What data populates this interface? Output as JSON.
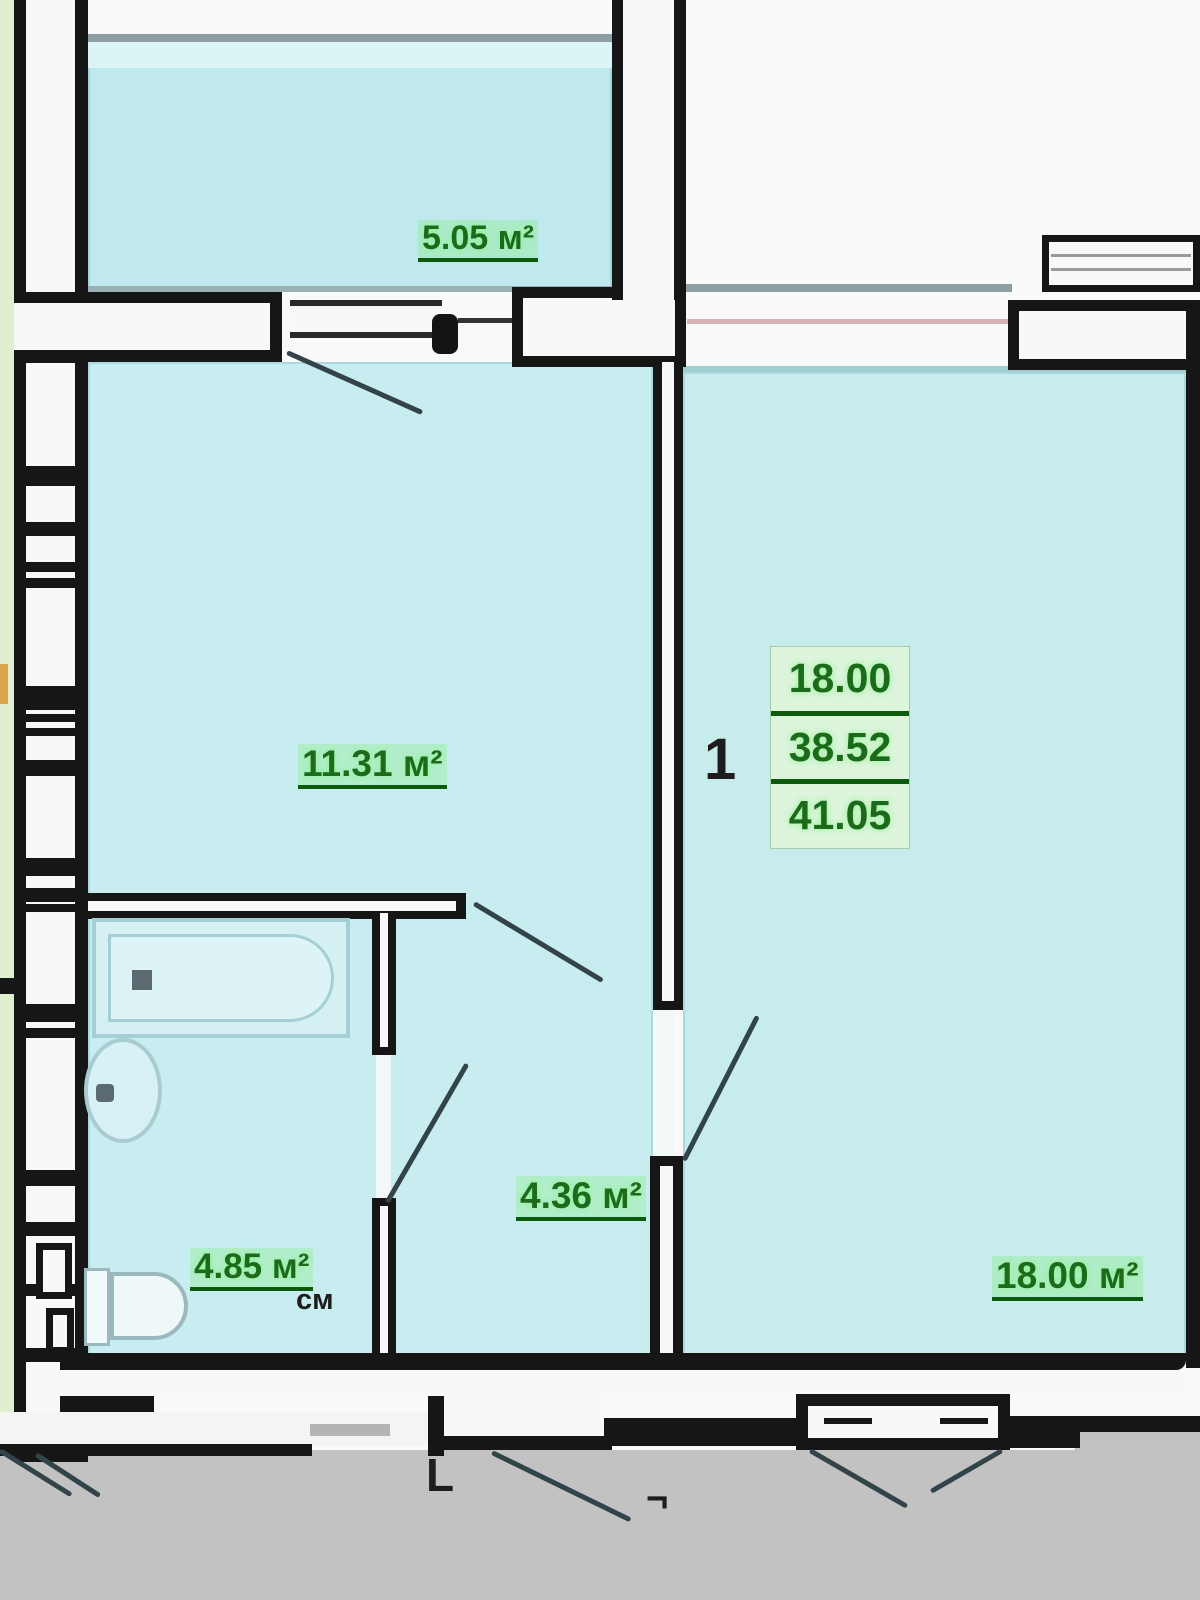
{
  "plan": {
    "title": "apartment-floor-plan",
    "apartment": {
      "number": "1",
      "areas": {
        "living": "18.00",
        "subtotal": "38.52",
        "total": "41.05"
      }
    },
    "rooms": {
      "balcony": {
        "label": "5.05 м²"
      },
      "room": {
        "label": "11.31 м²"
      },
      "hallway": {
        "label": "4.36 м²"
      },
      "bathroom": {
        "label": "4.85 м²"
      },
      "living_room": {
        "label": "18.00 м²"
      }
    },
    "annotations": {
      "washer": "см",
      "mark_l": "L",
      "mark_corner": "¬"
    },
    "colors": {
      "room_fill": "#c8edf1",
      "balcony_fill": "#bfe9ee",
      "label_green": "#1b6b1b",
      "label_glow": "#8df08d",
      "wall": "#161616",
      "ground": "#c2c2c2"
    }
  }
}
